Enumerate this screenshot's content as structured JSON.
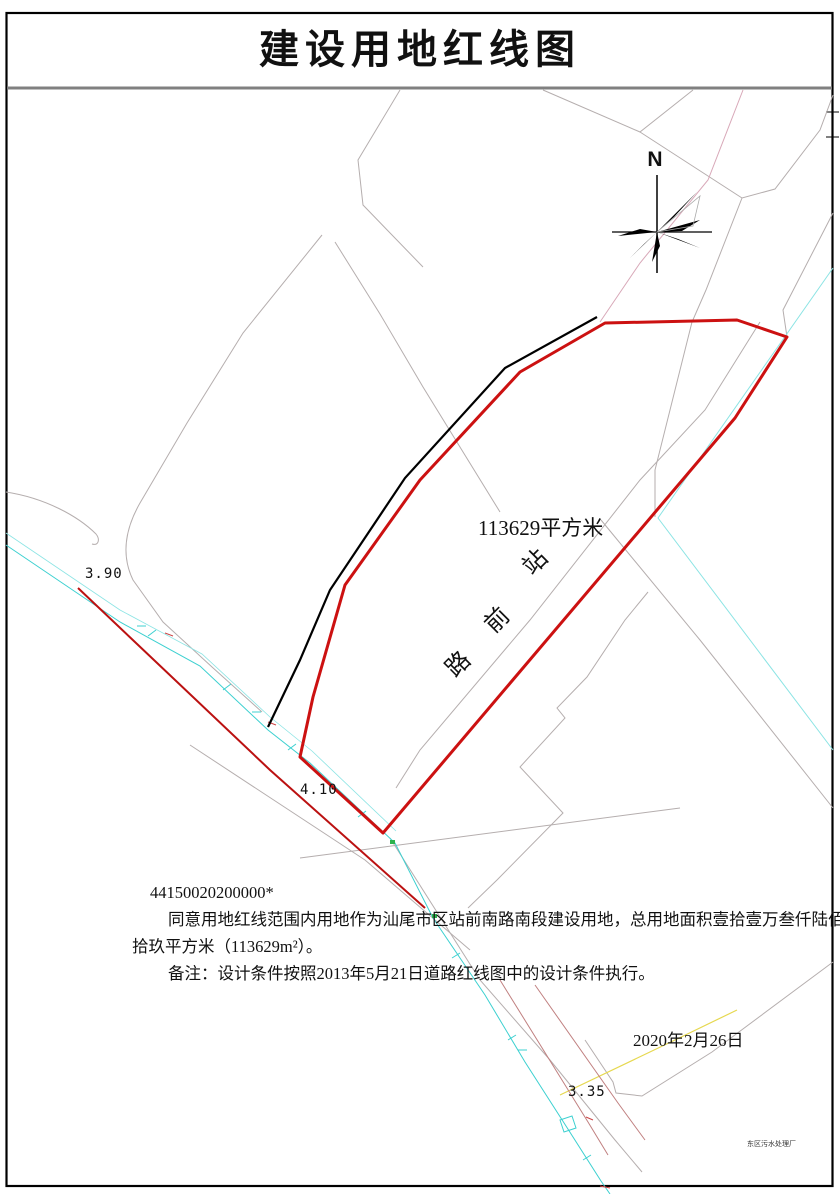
{
  "title": "建设用地红线图",
  "map": {
    "north_label": "N",
    "area_label": "113629平方米",
    "road_name": [
      "站",
      "前",
      "路"
    ],
    "elevations": [
      "3.90",
      "4.10",
      "3.35"
    ],
    "plant_label": "东区污水处理厂",
    "colors": {
      "redline": "#cc1111",
      "road_redline": "#bb1111",
      "canal": "#3cd0d0",
      "canal_light": "#8ce4e4",
      "elevation_green": "#00bb33"
    }
  },
  "annotations": {
    "code": "44150020200000*",
    "approval_line1": "同意用地红线范围内用地作为汕尾市区站前南路南段建设用地，总用地面积壹拾壹万叁仟陆佰贰",
    "approval_line2": "拾玖平方米（113629m²）。",
    "note": "备注：设计条件按照2013年5月21日道路红线图中的设计条件执行。",
    "date": "2020年2月26日"
  }
}
